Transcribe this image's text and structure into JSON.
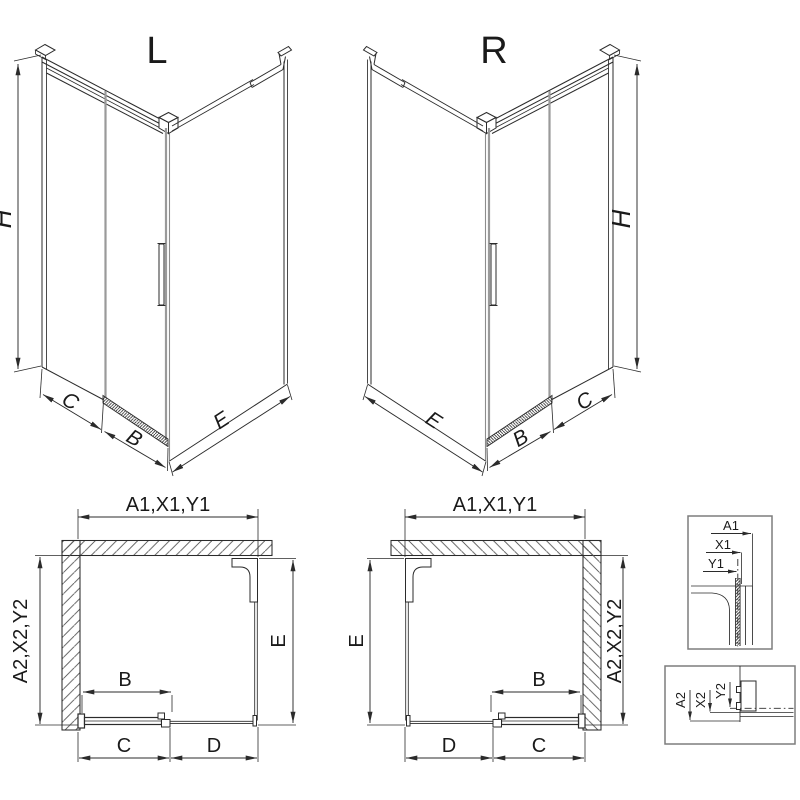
{
  "iso_left": {
    "title": "L",
    "dim_height": "H",
    "dim_front_fixed": "C",
    "dim_door": "B",
    "dim_side": "E"
  },
  "iso_right": {
    "title": "R",
    "dim_height": "H",
    "dim_front_fixed": "C",
    "dim_door": "B",
    "dim_side": "E"
  },
  "plan_left": {
    "dim_top": "A1,X1,Y1",
    "dim_left": "A2,X2,Y2",
    "dim_right": "E",
    "dim_door": "B",
    "dim_bottom_left": "C",
    "dim_bottom_right": "D"
  },
  "plan_right": {
    "dim_top": "A1,X1,Y1",
    "dim_right": "A2,X2,Y2",
    "dim_left": "E",
    "dim_door": "B",
    "dim_bottom_left": "D",
    "dim_bottom_right": "C"
  },
  "detail_top": {
    "dim_a": "A1",
    "dim_x": "X1",
    "dim_y": "Y1"
  },
  "detail_bottom": {
    "dim_a": "A2",
    "dim_x": "X2",
    "dim_y": "Y2"
  },
  "colors": {
    "line": "#2b2b2b",
    "glass_gray": "#9a9a9a",
    "detail_box_border": "#7d7d7d",
    "background": "#ffffff"
  }
}
